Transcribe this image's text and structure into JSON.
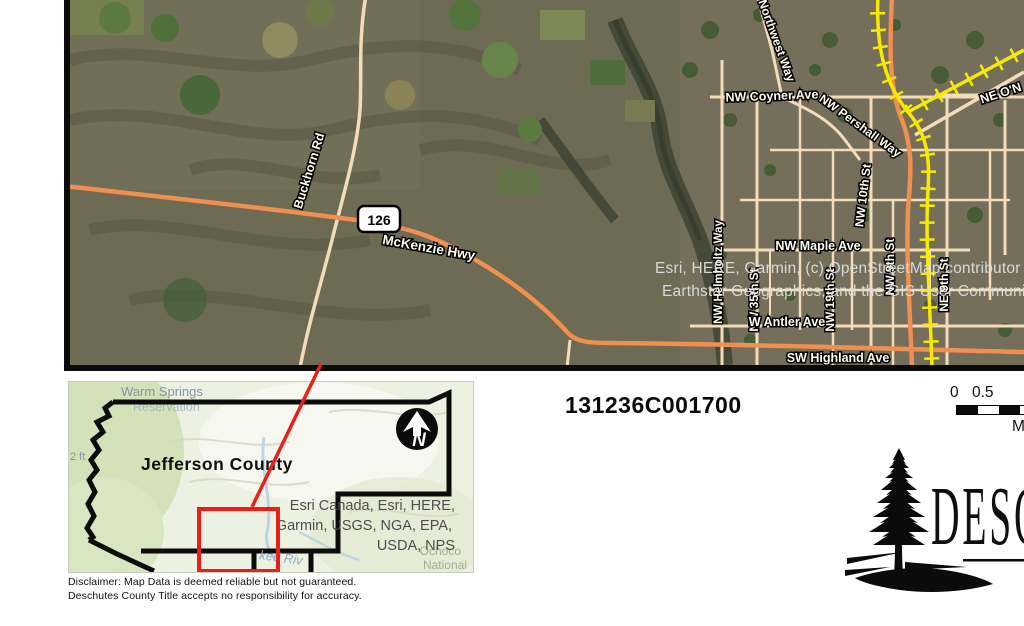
{
  "main_map": {
    "highway_shield": "126",
    "labels": {
      "buckhorn": "Buckhorn Rd",
      "mckenzie": "McKenzie Hwy",
      "northwest_way": "Northwest Way",
      "coyner": "NW Coyner Ave",
      "pershall": "NW Pershall Way",
      "ne_oneil_partial": "NE O'N",
      "helmholtz": "NW Helmholtz Way",
      "st35": "NW 35th St",
      "st19": "NW 19th St",
      "st10": "NW 10th St",
      "st9": "NW 9th St",
      "ne9": "NE 9th St",
      "maple": "NW Maple Ave",
      "antler": "W Antler Ave",
      "highland": "SW Highland Ave"
    },
    "attribution_line1": "Esri, HERE, Garmin, (c) OpenStreetMap contributor",
    "attribution_line2": "Earthstar Geographics, and the GIS User Communi"
  },
  "inset_map": {
    "county_label": "Jefferson County",
    "warm_springs": "Warm Springs",
    "reservation_partial": "Reservation",
    "elevation_partial": "2 ft",
    "river_partial": "ked Riv",
    "ochoco_line1": "Ochoco",
    "ochoco_line2": "National",
    "north_arrow_letter": "N",
    "attribution_line1": "Esri Canada, Esri, HERE,",
    "attribution_line2": "Garmin, USGS, NGA, EPA,",
    "attribution_line3": "USDA, NPS"
  },
  "annotations": {
    "parcel_id": "131236C001700"
  },
  "scale_bar": {
    "tick0": "0",
    "tick05": "0.5",
    "unit_partial": "M"
  },
  "disclaimer": {
    "line1": "Disclaimer:  Map Data is deemed reliable but not guaranteed.",
    "line2": "Deschutes County Title accepts no responsibility for accuracy."
  },
  "logo": {
    "text_partial": "DESC"
  },
  "colors": {
    "road_tan": "#f3dcba",
    "highway_orange": "#ef8f50",
    "railroad_yellow": "#f6ea00",
    "locator_red": "#e8201a",
    "terrain_base": "#6e6b55",
    "inset_bg": "#edf1e2",
    "boundary_black": "#0c0c0c"
  }
}
